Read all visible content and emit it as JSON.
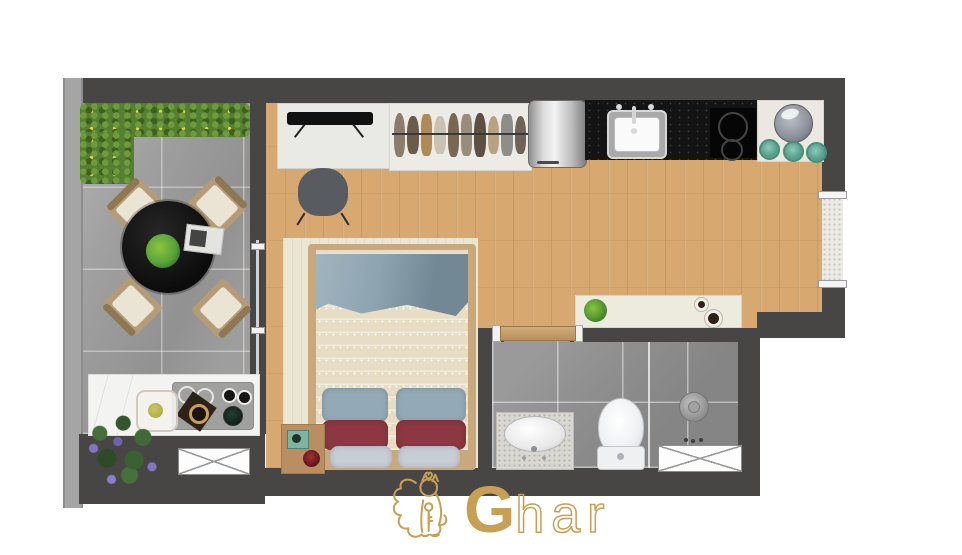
{
  "logo": {
    "initial": "G",
    "rest": "har",
    "icon": "lion-with-key-icon"
  },
  "colors": {
    "wall": "#484644",
    "wall_light": "#a5a5a5",
    "terrace_tile": "#9e9e9e",
    "bath_tile": "#8f8f8f",
    "wood": "#d7a870",
    "counter_black": "#141414",
    "counter_white": "#eae8e0",
    "marble": "#f3f3f1",
    "rug": "#e9e7d3",
    "blanket": "#e7ddc4",
    "throw": "#8da4b1",
    "pillow_blue": "#93a9b6",
    "pillow_red": "#8c3741",
    "pillow_gray": "#c7ccd5",
    "bed_wood": "#c9a87c",
    "hedge": "#557f31",
    "table_black": "#161616",
    "chair_wood": "#b59c77",
    "chair_cushion": "#eae4d4",
    "teal": "#56a08c",
    "tray": "#a0a09e",
    "plant_green": "#57a33a",
    "flower_purple": "#8276c2",
    "gold": "#c79f55"
  },
  "wardrobe": {
    "clothes_colors": [
      "#8a7b6b",
      "#6b5b4b",
      "#b08a54",
      "#c9c2b4",
      "#7b6652",
      "#9a8c7a",
      "#5d4f41",
      "#b7a284",
      "#8d8d89",
      "#6f6358"
    ]
  }
}
